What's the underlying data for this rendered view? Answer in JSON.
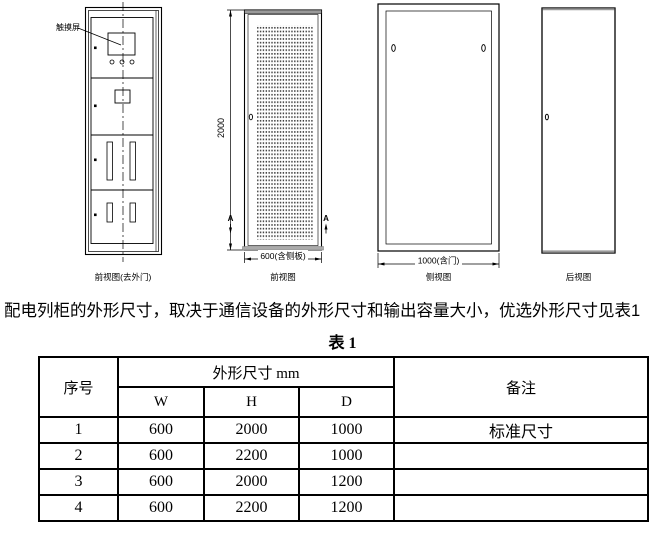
{
  "colors": {
    "line": "#000000",
    "background": "#ffffff",
    "cap_gray": "#9a9a9a"
  },
  "drawing": {
    "front_no_door": {
      "caption": "前视图(去外门)",
      "label_touchscreen": "触摸屏"
    },
    "front": {
      "caption": "前视图",
      "dim_height": "2000",
      "dim_width": "600(含侧板)",
      "section_letter": "A"
    },
    "side": {
      "caption": "侧视图",
      "dim_depth": "1000(含门)"
    },
    "rear": {
      "caption": "后视图"
    }
  },
  "paragraph": "配电列柜的外形尺寸，取决于通信设备的外形尺寸和输出容量大小，优选外形尺寸见表1",
  "table": {
    "title": "表 1",
    "header": {
      "index": "序号",
      "dims": "外形尺寸 mm",
      "w": "W",
      "h": "H",
      "d": "D",
      "remark": "备注"
    },
    "rows": [
      {
        "no": "1",
        "w": "600",
        "h": "2000",
        "d": "1000",
        "remark": "标准尺寸"
      },
      {
        "no": "2",
        "w": "600",
        "h": "2200",
        "d": "1000",
        "remark": ""
      },
      {
        "no": "3",
        "w": "600",
        "h": "2000",
        "d": "1200",
        "remark": ""
      },
      {
        "no": "4",
        "w": "600",
        "h": "2200",
        "d": "1200",
        "remark": ""
      }
    ]
  }
}
